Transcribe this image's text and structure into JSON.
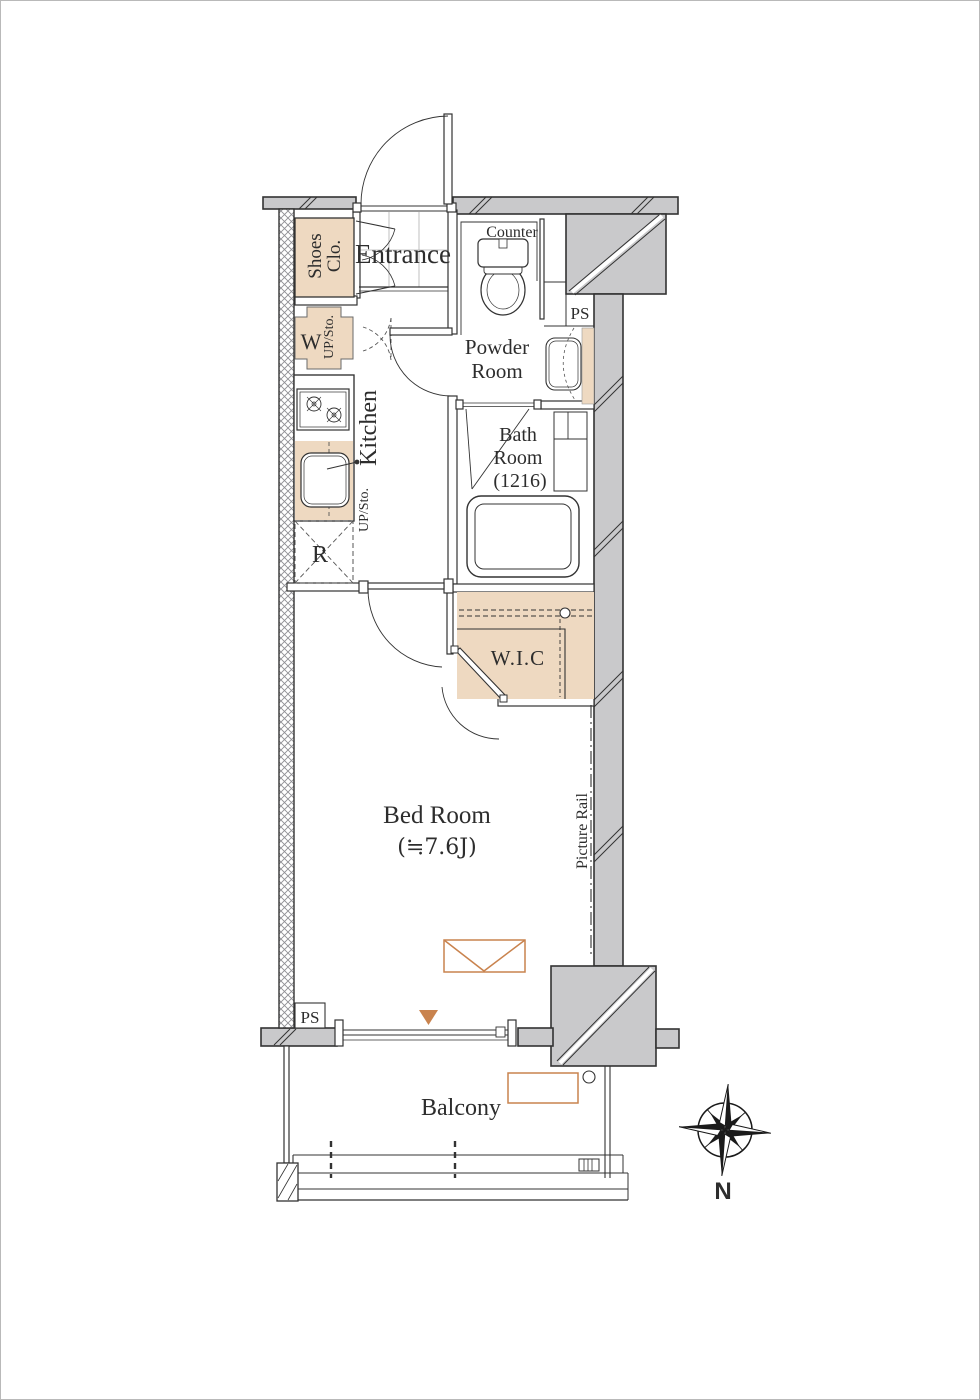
{
  "colors": {
    "wall_fill": "#c9c9cb",
    "accent_beige": "#eed9c1",
    "accent_orange": "#c9834e",
    "outline": "#333333",
    "hatch_line": "#8f8f94"
  },
  "labels": {
    "entrance": "Entrance",
    "shoes_closet_1": "Shoes",
    "shoes_closet_2": "Clo.",
    "counter": "Counter",
    "powder_room_1": "Powder",
    "powder_room_2": "Room",
    "ps_upper": "PS",
    "bath_room_1": "Bath",
    "bath_room_2": "Room",
    "bath_room_3": "(1216)",
    "kitchen": "Kitchen",
    "washer": "W",
    "up_storage_upper": "UP/Sto.",
    "up_storage_lower": "UP/Sto.",
    "refrigerator": "R",
    "walk_in_closet": "W.I.C",
    "bed_room_1": "Bed Room",
    "bed_room_2": "(≒7.6J)",
    "picture_rail": "Picture Rail",
    "ps_lower": "PS",
    "balcony": "Balcony",
    "compass_north": "N"
  }
}
